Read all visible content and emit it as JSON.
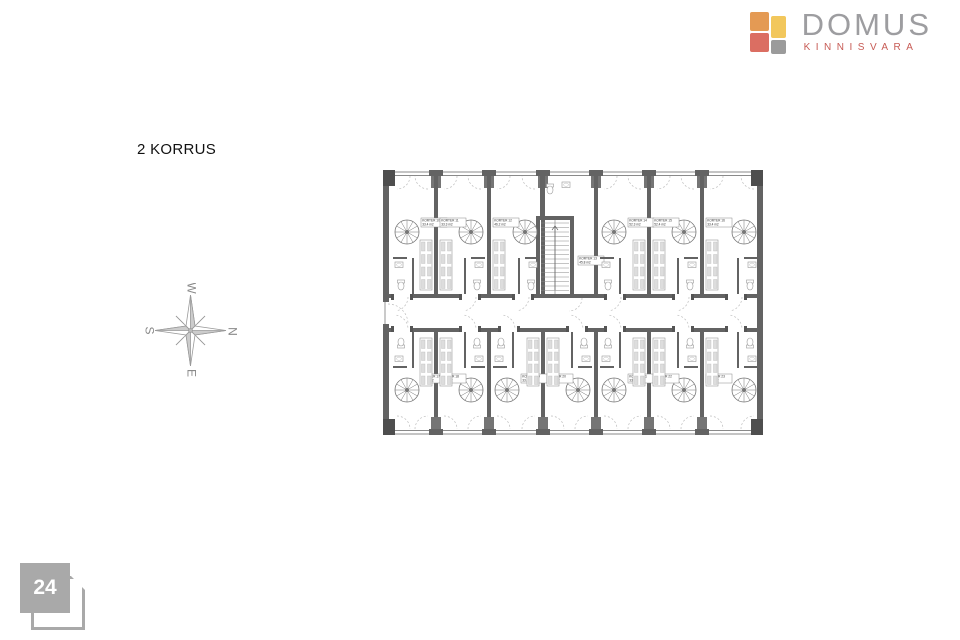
{
  "page": {
    "title": "2 KORRUS",
    "page_number": "24"
  },
  "logo": {
    "name": "DOMUS",
    "subtitle": "KINNISVARA",
    "colors": {
      "orange": "#e49a54",
      "yellow": "#f2c75c",
      "red": "#db6e62",
      "gray": "#9b9b9b",
      "text_gray": "#9d9da0",
      "text_red": "#c75b55"
    }
  },
  "compass": {
    "top": "W",
    "right": "N",
    "bottom": "E",
    "left": "S"
  },
  "floorplan": {
    "wall_color": "#636363",
    "pier_color": "#757575",
    "thin_color": "#8a8a8a",
    "dash_color": "#bdbdbd",
    "units": [
      {
        "label": "KORTER 10",
        "area": "33.4 m2",
        "row": "top",
        "bay": 0,
        "mirror": false
      },
      {
        "label": "KORTER 11",
        "area": "33.3 m2",
        "row": "top",
        "bay": 1,
        "mirror": true
      },
      {
        "label": "KORTER 12",
        "area": "46.2 m2",
        "row": "top",
        "bay": 2,
        "mirror": true
      },
      {
        "label": "KORTER 13",
        "area": "45.8 m2",
        "row": "top",
        "bay": 3,
        "mirror": false,
        "core": true
      },
      {
        "label": "KORTER 14",
        "area": "52.3 m2",
        "row": "top",
        "bay": 4,
        "mirror": false
      },
      {
        "label": "KORTER 15",
        "area": "52.4 m2",
        "row": "top",
        "bay": 5,
        "mirror": true
      },
      {
        "label": "KORTER 16",
        "area": "33.4 m2",
        "row": "top",
        "bay": 6,
        "mirror": true
      },
      {
        "label": "KORTER 17",
        "area": "33.4 m2",
        "row": "bottom",
        "bay": 0,
        "mirror": false
      },
      {
        "label": "KORTER 18",
        "area": "33.5 m2",
        "row": "bottom",
        "bay": 1,
        "mirror": true
      },
      {
        "label": "KORTER 19",
        "area": "33.4 m2",
        "row": "bottom",
        "bay": 2,
        "mirror": false
      },
      {
        "label": "KORTER 20",
        "area": "33.6 m2",
        "row": "bottom",
        "bay": 3,
        "mirror": true
      },
      {
        "label": "KORTER 21",
        "area": "33.4 m2",
        "row": "bottom",
        "bay": 4,
        "mirror": false
      },
      {
        "label": "KORTER 22",
        "area": "33.3 m2",
        "row": "bottom",
        "bay": 5,
        "mirror": true
      },
      {
        "label": "KORTER 23",
        "area": "33.4 m2",
        "row": "bottom",
        "bay": 6,
        "mirror": true
      }
    ]
  }
}
